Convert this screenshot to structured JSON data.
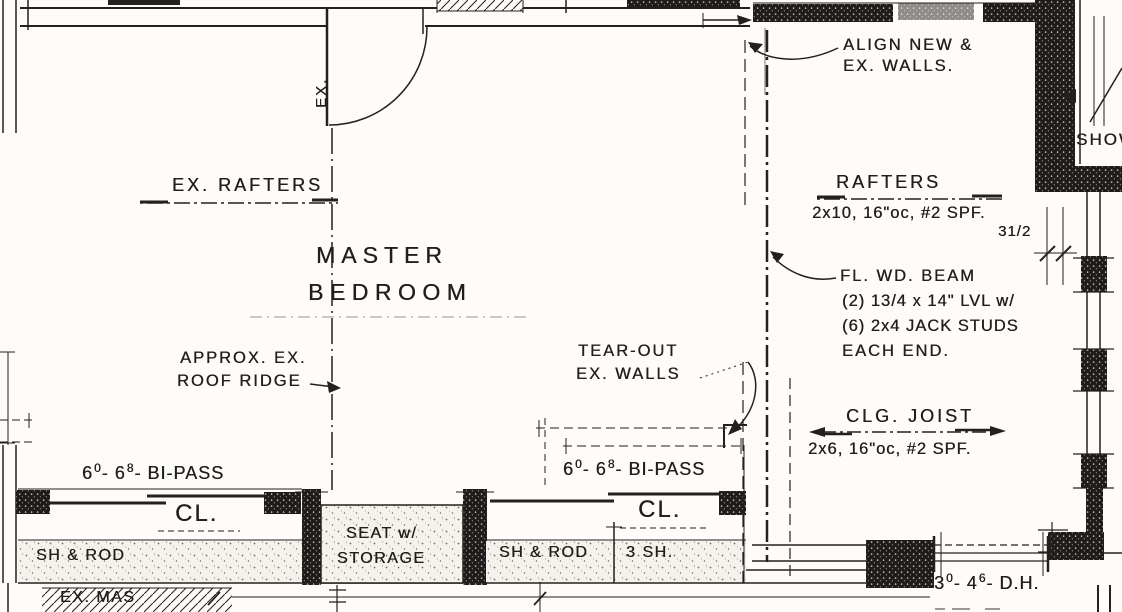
{
  "labels": {
    "align_1": "ALIGN NEW &",
    "align_2": "EX. WALLS.",
    "shower": "SHOW",
    "ex_rafters": "EX. RAFTERS",
    "room_1": "MASTER",
    "room_2": "BEDROOM",
    "rafters_title": "RAFTERS",
    "rafters_spec": "2x10, 16\"oc, #2 SPF.",
    "dim_3half": "31/2",
    "beam_1": "FL. WD. BEAM",
    "beam_2": "(2) 13/4 x 14\" LVL w/",
    "beam_3": "(6) 2x4 JACK STUDS",
    "beam_4": "EACH END.",
    "clg_title": "CLG. JOIST",
    "clg_spec": "2x6, 16\"oc, #2 SPF.",
    "ridge_1": "APPROX. EX.",
    "ridge_2": "ROOF RIDGE",
    "tear_1": "TEAR-OUT",
    "tear_2": "EX. WALLS",
    "cl_left": "CL.",
    "cl_right": "CL.",
    "sh_rod_left": "SH & ROD",
    "sh_rod_right": "SH & ROD",
    "seat_1": "SEAT w/",
    "seat_2": "STORAGE",
    "three_sh": "3 SH.",
    "ex_masonry": "EX. MAS",
    "ex_door": "EX."
  },
  "closet_left": {
    "w": "6",
    "w_sup": "0",
    "sep1": "-",
    "h": "6",
    "h_sup": "8",
    "sep2": "-",
    "type": "BI-PASS"
  },
  "closet_right": {
    "w": "6",
    "w_sup": "0",
    "sep1": "-",
    "h": "6",
    "h_sup": "8",
    "sep2": "-",
    "type": "BI-PASS"
  },
  "window_dh": {
    "w": "3",
    "w_sup": "0",
    "sep1": "-",
    "h": "4",
    "h_sup": "6",
    "sep2": "-",
    "type": "D.H."
  },
  "colors": {
    "ink": "#24211d",
    "paper": "#fdfcfa",
    "stipple_bg": "#f4f2ec"
  }
}
